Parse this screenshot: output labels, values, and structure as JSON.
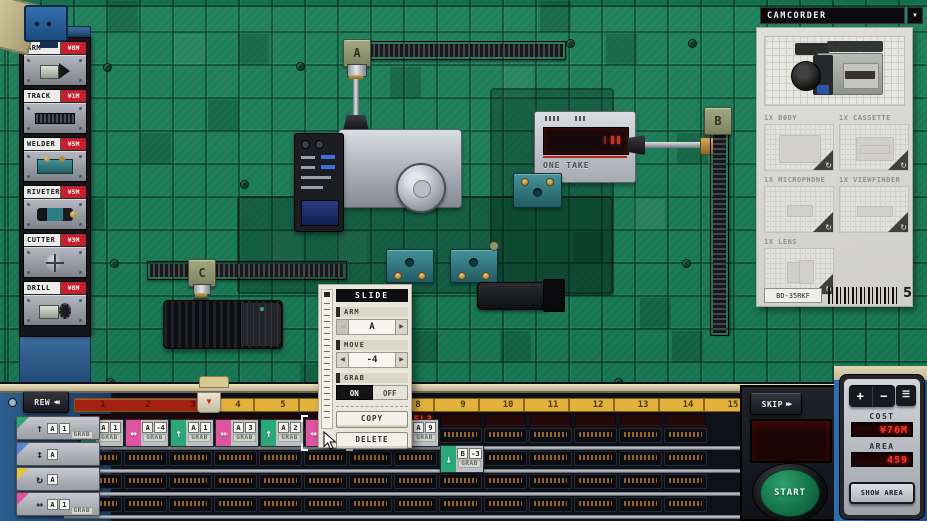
{
  "colors": {
    "green": "#2aa87a",
    "pink": "#df549e",
    "blue": "#5b82d8",
    "yellow": "#e5c33e",
    "accent_red": "#c41f2e",
    "led_red": "#ff3726"
  },
  "sidebar": {
    "tools": [
      {
        "label": "ARM",
        "price": "¥8M",
        "icon": "arm-icon"
      },
      {
        "label": "TRACK",
        "price": "¥1M",
        "icon": "track-icon"
      },
      {
        "label": "WELDER",
        "price": "¥5M",
        "icon": "welder-icon"
      },
      {
        "label": "RIVETER",
        "price": "¥5M",
        "icon": "riveter-icon"
      },
      {
        "label": "CUTTER",
        "price": "¥3M",
        "icon": "cutter-icon"
      },
      {
        "label": "DRILL",
        "price": "¥8M",
        "icon": "drill-icon"
      }
    ]
  },
  "board": {
    "arm_a": "A",
    "arm_b": "B",
    "arm_c": "C",
    "device_text": "ONE TAKE"
  },
  "popup": {
    "title": "SLIDE",
    "arm": {
      "label": "ARM",
      "value": "A",
      "prev": "◀",
      "next": "▶"
    },
    "move": {
      "label": "MOVE",
      "value": "-4",
      "prev": "◀",
      "next": "▶"
    },
    "grab": {
      "label": "GRAB",
      "on": "ON",
      "off": "OFF"
    },
    "copy": "COPY",
    "delete": "DELETE",
    "scroll_icon": "↓"
  },
  "timeline": {
    "rew_label": "REW",
    "rew_icon": "◀◀",
    "skip_label": "SKIP",
    "skip_icon": "▶▶",
    "marker_icon": "▼",
    "ruler_numbers": [
      "1",
      "2",
      "3",
      "4",
      "5",
      "6",
      "7",
      "8",
      "9",
      "10",
      "11",
      "12",
      "13",
      "14",
      "15"
    ],
    "red_columns": 3,
    "led": {
      "col": 8,
      "text": "EL3"
    },
    "palette": [
      {
        "color": "green",
        "icon": "up",
        "cells": [
          "A",
          "1"
        ],
        "tag": "GRAB"
      },
      {
        "color": "blue",
        "icon": "ud",
        "cells": [
          "A"
        ]
      },
      {
        "color": "yellow",
        "icon": "rot",
        "cells": [
          "A"
        ]
      },
      {
        "color": "pink",
        "icon": "lr",
        "cells": [
          "A",
          "1"
        ],
        "tag": "GRAB"
      }
    ],
    "blocks": [
      {
        "row": 1,
        "col": 1,
        "color": "green",
        "icon": "up",
        "cells": [
          "A",
          "1"
        ],
        "tag": "GRAB"
      },
      {
        "row": 1,
        "col": 2,
        "color": "pink",
        "icon": "lr",
        "cells": [
          "A",
          "-4"
        ],
        "tag": "GRAB"
      },
      {
        "row": 1,
        "col": 3,
        "color": "green",
        "icon": "up",
        "cells": [
          "A",
          "1"
        ],
        "tag": "GRAB"
      },
      {
        "row": 1,
        "col": 4,
        "color": "pink",
        "icon": "lr",
        "cells": [
          "A",
          "3"
        ],
        "tag": "GRAB"
      },
      {
        "row": 1,
        "col": 5,
        "color": "green",
        "icon": "up",
        "cells": [
          "A",
          "2"
        ],
        "tag": "GRAB"
      },
      {
        "row": 1,
        "col": 6,
        "color": "pink",
        "icon": "lr",
        "cells": [
          "A",
          "-4"
        ],
        "tag": "GRAB",
        "selected": true
      },
      {
        "row": 1,
        "col": 8,
        "color": "pink",
        "icon": "lr",
        "cells": [
          "A",
          "9"
        ],
        "tag": "GRAB"
      },
      {
        "row": 2,
        "col": 9,
        "color": "green",
        "icon": "down",
        "cells": [
          "B",
          "-3"
        ],
        "tag": "GRAB"
      }
    ]
  },
  "product_panel": {
    "title": "CAMCORDER",
    "dropdown_icon": "▼",
    "rotate_icon": "↻",
    "parts": [
      {
        "label": "1X B0DY",
        "kind": "body"
      },
      {
        "label": "1X CASSETTE",
        "kind": "cassette"
      },
      {
        "label": "1X MICROPHONE",
        "kind": "microphone"
      },
      {
        "label": "1X VIEWFINDER",
        "kind": "viewfinder"
      },
      {
        "label": "1X LENS",
        "kind": "lens"
      }
    ],
    "code": "BD-35RKF",
    "count": "5"
  },
  "cost_panel": {
    "plus": "+",
    "minus": "−",
    "menu_icon": "☰",
    "cost_label": "COST",
    "cost_value": "¥76M",
    "area_label": "AREA",
    "area_value": "459",
    "show_area_label": "SHOW AREA"
  }
}
